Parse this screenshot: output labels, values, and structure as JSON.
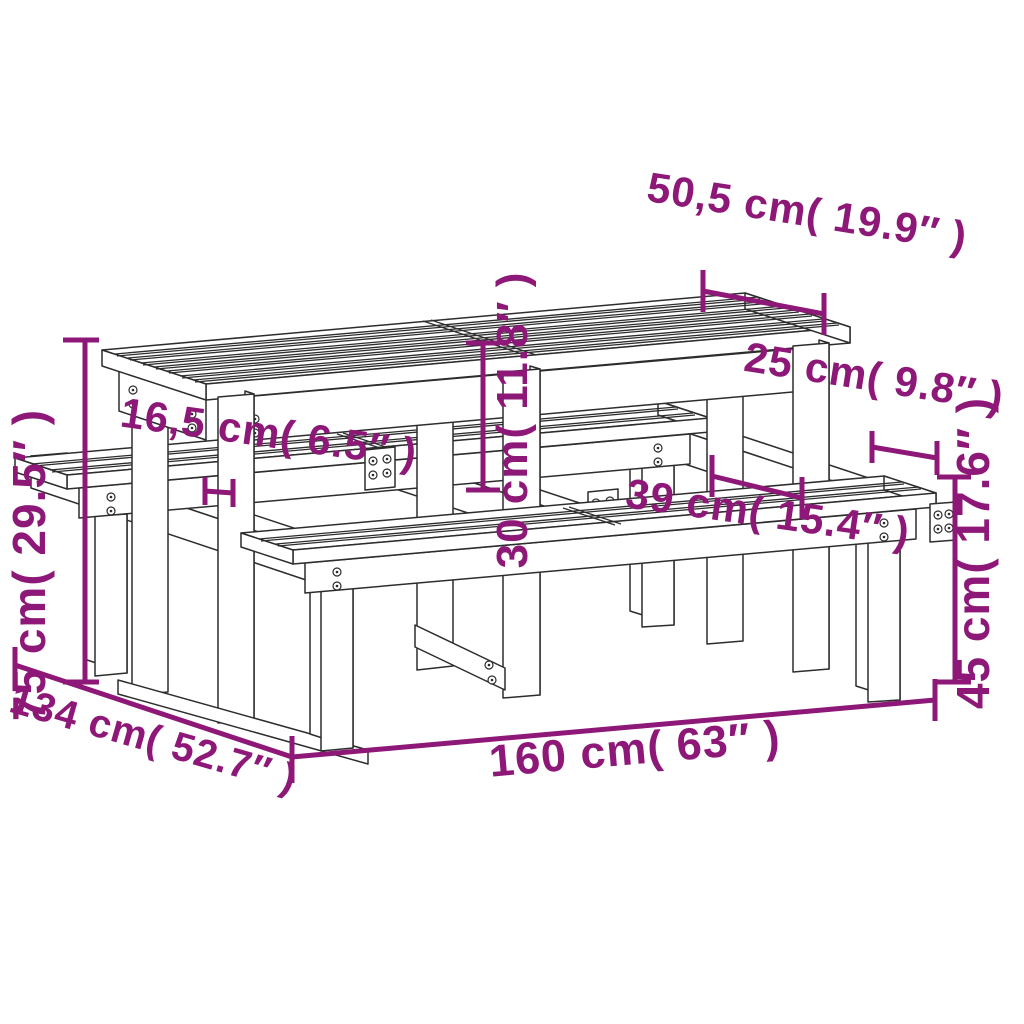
{
  "diagram": {
    "subject": "picnic-table-with-benches-dimension-diagram",
    "background_color": "#ffffff",
    "line_color": "#2d2d2d",
    "dimension_color": "#8e1878"
  },
  "dimensions": [
    {
      "id": "tabletop-depth",
      "cm": "50,5",
      "inches": "19.9",
      "text": "50,5 cm( 19.9″ )"
    },
    {
      "id": "bench-seat-depth",
      "cm": "25",
      "inches": "9.8",
      "text": "25 cm( 9.8″ )"
    },
    {
      "id": "bench-to-table-gap",
      "cm": "16,5",
      "inches": "6.5",
      "text": "16,5 cm( 6.5″ )"
    },
    {
      "id": "seat-to-tabletop",
      "cm": "30",
      "inches": "11.8",
      "text": "30 cm( 11.8″ )"
    },
    {
      "id": "seat-beam-overhang",
      "cm": "39",
      "inches": "15.4",
      "text": "39 cm( 15.4″ )"
    },
    {
      "id": "table-height",
      "cm": "75",
      "inches": "29.5",
      "text": "75 cm( 29.5″ )"
    },
    {
      "id": "total-depth",
      "cm": "134",
      "inches": "52.7",
      "text": "134 cm( 52.7″ )"
    },
    {
      "id": "total-length",
      "cm": "160",
      "inches": "63",
      "text": "160 cm( 63″ )"
    },
    {
      "id": "bench-height",
      "cm": "45",
      "inches": "17.6",
      "text": "45 cm( 17.6″ )"
    }
  ]
}
